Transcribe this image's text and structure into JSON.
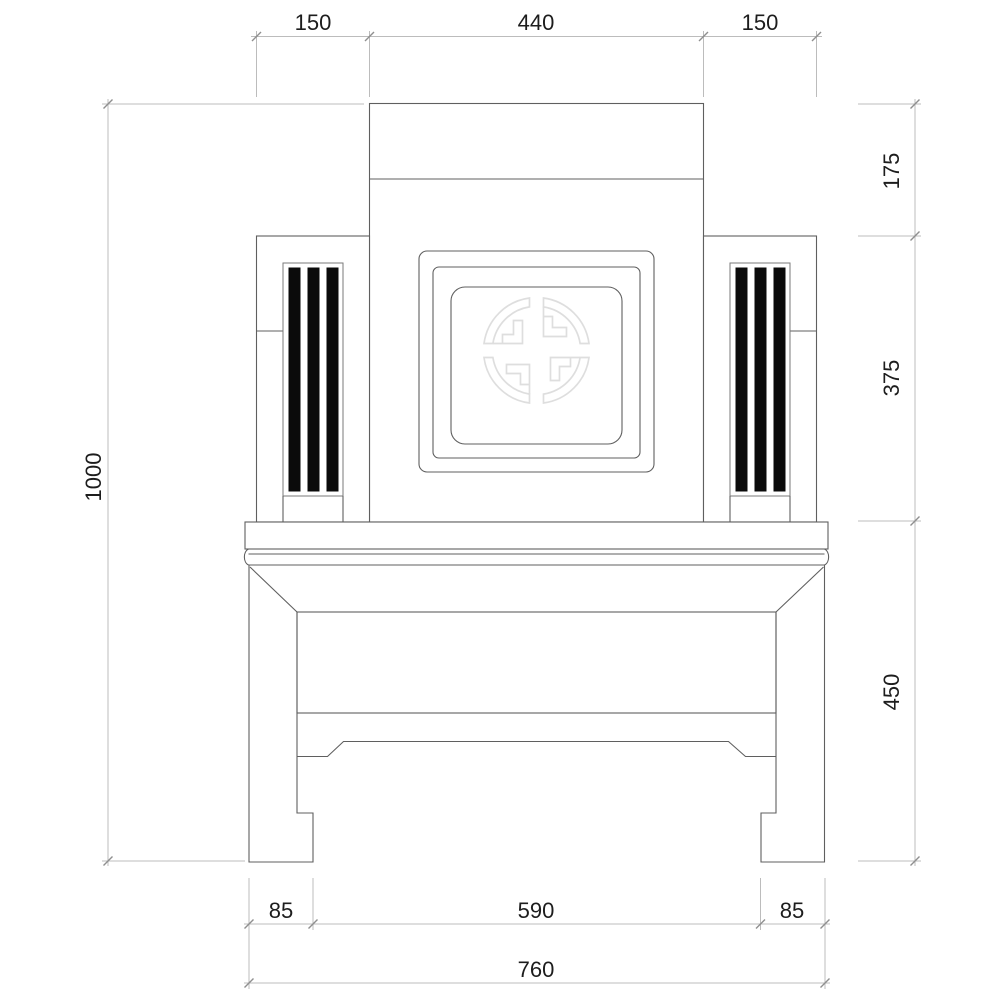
{
  "colors": {
    "object_line": "#5f5f5f",
    "dim_line": "#bcbcbc",
    "tick": "#8f8f8f",
    "text_color": "#1d1d1d",
    "stripe_fill": "#0b0b0b",
    "medallion_line": "#dedede",
    "flute_line": "#8c8c8c",
    "bg": "#ffffff"
  },
  "dimensions": {
    "top": {
      "left_armrest": "150",
      "backrest": "440",
      "right_armrest": "150"
    },
    "side_left": {
      "overall_height": "1000"
    },
    "side_right": {
      "crest": "175",
      "backrest": "375",
      "base": "450"
    },
    "bottom": {
      "left_foot": "85",
      "leg_span": "590",
      "right_foot": "85",
      "overall_width": "760"
    }
  }
}
